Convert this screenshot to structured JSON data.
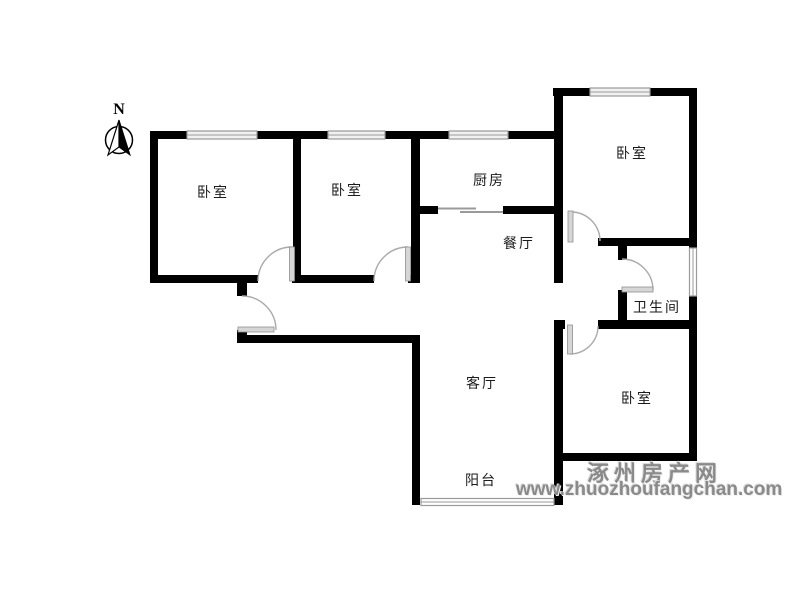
{
  "compass": {
    "north_label": "N"
  },
  "rooms": {
    "bedroom_nw": "卧室",
    "bedroom_n": "卧室",
    "kitchen": "厨房",
    "dining": "餐厅",
    "bedroom_ne": "卧室",
    "bathroom": "卫生间",
    "bedroom_se": "卧室",
    "living": "客厅",
    "balcony": "阳台"
  },
  "watermark": {
    "site_name": "涿州房产网",
    "site_url": "www.zhuozhoufangchan.com"
  },
  "colors": {
    "wall": "#000000",
    "window": "#9a9a9a",
    "door": "#aaaaaa",
    "label_text": "#1b1b1b",
    "watermark_text": "#8a8a8a",
    "background": "#ffffff"
  }
}
